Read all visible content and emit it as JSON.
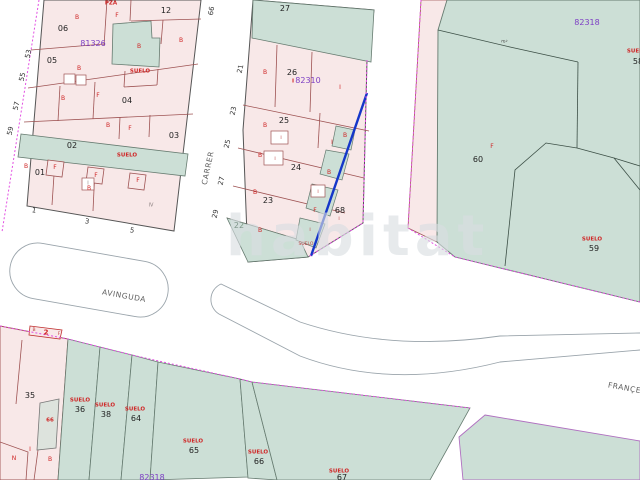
{
  "map": {
    "watermark": "habitat",
    "blocks": [
      {
        "id": "81326",
        "position": "top-left"
      },
      {
        "id": "82310",
        "position": "top-middle"
      },
      {
        "id": "82318",
        "position": "top-right"
      },
      {
        "id": "82318",
        "position": "bottom"
      }
    ],
    "streets": [
      {
        "name": "AVINGUDA"
      },
      {
        "name": "CARRER"
      },
      {
        "name": "FRANÇESC"
      }
    ],
    "selected_boundary_color": "#1536c9",
    "boundary_dash_color": "#e24fe2",
    "parcel_fill_pink": "#f8e8e8",
    "parcel_fill_green": "#ccdfd6",
    "block_label_color": "#7d3fc4",
    "status_label_color": "#cf2525",
    "labels": [
      {
        "t": "PZA",
        "c": "su",
        "x": 111,
        "y": 4
      },
      {
        "t": "06",
        "c": "pn",
        "x": 63,
        "y": 29
      },
      {
        "t": "12",
        "c": "pn",
        "x": 166,
        "y": 11
      },
      {
        "t": "81326",
        "c": "bk",
        "x": 93,
        "y": 44
      },
      {
        "t": "B",
        "c": "rl",
        "x": 77,
        "y": 18
      },
      {
        "t": "F",
        "c": "rl",
        "x": 117,
        "y": 16
      },
      {
        "t": "B",
        "c": "rl",
        "x": 181,
        "y": 41
      },
      {
        "t": "B",
        "c": "rl",
        "x": 139,
        "y": 47
      },
      {
        "t": "05",
        "c": "pn",
        "x": 52,
        "y": 61
      },
      {
        "t": "SUELO",
        "c": "su",
        "x": 140,
        "y": 72
      },
      {
        "t": "B",
        "c": "rl",
        "x": 79,
        "y": 69
      },
      {
        "t": "04",
        "c": "pn",
        "x": 127,
        "y": 101
      },
      {
        "t": "B",
        "c": "rl",
        "x": 63,
        "y": 99
      },
      {
        "t": "F",
        "c": "rl",
        "x": 98,
        "y": 96
      },
      {
        "t": "03",
        "c": "pn",
        "x": 174,
        "y": 136
      },
      {
        "t": "B",
        "c": "rl",
        "x": 108,
        "y": 126
      },
      {
        "t": "F",
        "c": "rl",
        "x": 130,
        "y": 129
      },
      {
        "t": "02",
        "c": "pn",
        "x": 72,
        "y": 146
      },
      {
        "t": "SUELO",
        "c": "su",
        "x": 127,
        "y": 156
      },
      {
        "t": "01",
        "c": "pn",
        "x": 40,
        "y": 173
      },
      {
        "t": "B",
        "c": "rl",
        "x": 26,
        "y": 167
      },
      {
        "t": "F",
        "c": "rl",
        "x": 55,
        "y": 168
      },
      {
        "t": "F",
        "c": "rl",
        "x": 96,
        "y": 176
      },
      {
        "t": "F",
        "c": "rl",
        "x": 138,
        "y": 181
      },
      {
        "t": "B",
        "c": "rl",
        "x": 89,
        "y": 189
      },
      {
        "t": "I",
        "c": "gy",
        "x": 88,
        "y": 184
      },
      {
        "t": "IV",
        "c": "gy",
        "x": 151,
        "y": 206
      },
      {
        "t": "53",
        "c": "st",
        "x": 29,
        "y": 54,
        "r": -78
      },
      {
        "t": "55",
        "c": "st",
        "x": 23,
        "y": 77,
        "r": -78
      },
      {
        "t": "57",
        "c": "st",
        "x": 17,
        "y": 106,
        "r": -78
      },
      {
        "t": "59",
        "c": "st",
        "x": 11,
        "y": 131,
        "r": -78
      },
      {
        "t": "1",
        "c": "st",
        "x": 34,
        "y": 211,
        "r": 10
      },
      {
        "t": "3",
        "c": "st",
        "x": 87,
        "y": 222,
        "r": 10
      },
      {
        "t": "5",
        "c": "st",
        "x": 132,
        "y": 231,
        "r": 10
      },
      {
        "t": "66",
        "c": "st",
        "x": 212,
        "y": 11,
        "r": -80
      },
      {
        "t": "21",
        "c": "st",
        "x": 241,
        "y": 69,
        "r": -78
      },
      {
        "t": "23",
        "c": "st",
        "x": 234,
        "y": 111,
        "r": -78
      },
      {
        "t": "25",
        "c": "st",
        "x": 228,
        "y": 144,
        "r": -78
      },
      {
        "t": "27",
        "c": "st",
        "x": 222,
        "y": 181,
        "r": -78
      },
      {
        "t": "29",
        "c": "st",
        "x": 216,
        "y": 214,
        "r": -78
      },
      {
        "t": "CARRER",
        "c": "sn",
        "x": 208,
        "y": 168,
        "r": -78
      },
      {
        "t": "27",
        "c": "pn",
        "x": 285,
        "y": 9
      },
      {
        "t": "26",
        "c": "pn",
        "x": 292,
        "y": 73
      },
      {
        "t": "82310",
        "c": "bk",
        "x": 308,
        "y": 81
      },
      {
        "t": "I",
        "c": "su",
        "x": 293,
        "y": 82
      },
      {
        "t": "B",
        "c": "rl",
        "x": 265,
        "y": 73
      },
      {
        "t": "I",
        "c": "rl",
        "x": 340,
        "y": 88
      },
      {
        "t": "25",
        "c": "pn",
        "x": 284,
        "y": 121
      },
      {
        "t": "B",
        "c": "rl",
        "x": 265,
        "y": 126
      },
      {
        "t": "I",
        "c": "tr",
        "x": 281,
        "y": 139
      },
      {
        "t": "I",
        "c": "rl",
        "x": 332,
        "y": 143
      },
      {
        "t": "24",
        "c": "pn",
        "x": 296,
        "y": 168
      },
      {
        "t": "B",
        "c": "rl",
        "x": 260,
        "y": 156
      },
      {
        "t": "I",
        "c": "tr",
        "x": 275,
        "y": 160
      },
      {
        "t": "23",
        "c": "pn",
        "x": 268,
        "y": 201
      },
      {
        "t": "B",
        "c": "rl",
        "x": 255,
        "y": 193
      },
      {
        "t": "22",
        "c": "pg",
        "x": 239,
        "y": 226
      },
      {
        "t": "B",
        "c": "rl",
        "x": 260,
        "y": 231
      },
      {
        "t": "68",
        "c": "pn",
        "x": 340,
        "y": 211
      },
      {
        "t": "I",
        "c": "tr",
        "x": 339,
        "y": 220
      },
      {
        "t": "B",
        "c": "rl",
        "x": 345,
        "y": 136
      },
      {
        "t": "B",
        "c": "rl",
        "x": 329,
        "y": 173
      },
      {
        "t": "I",
        "c": "tr",
        "x": 318,
        "y": 193
      },
      {
        "t": "F",
        "c": "rl",
        "x": 315,
        "y": 211
      },
      {
        "t": "I",
        "c": "tr",
        "x": 310,
        "y": 231
      },
      {
        "t": "SUELO",
        "c": "tr",
        "x": 306,
        "y": 245
      },
      {
        "t": "82318",
        "c": "bk",
        "x": 587,
        "y": 23
      },
      {
        "t": "m²",
        "c": "tn",
        "x": 504,
        "y": 43,
        "r": 10
      },
      {
        "t": "F",
        "c": "rl",
        "x": 492,
        "y": 147
      },
      {
        "t": "60",
        "c": "pn",
        "x": 478,
        "y": 160
      },
      {
        "t": "SUELO",
        "c": "su",
        "x": 592,
        "y": 240
      },
      {
        "t": "59",
        "c": "pn",
        "x": 594,
        "y": 249
      },
      {
        "t": "SUELO",
        "c": "su",
        "x": 637,
        "y": 52
      },
      {
        "t": "58",
        "c": "pn",
        "x": 638,
        "y": 62
      },
      {
        "t": "AVINGUDA",
        "c": "sn",
        "x": 124,
        "y": 296,
        "r": 10
      },
      {
        "t": "FRANÇESC",
        "c": "sn",
        "x": 630,
        "y": 389,
        "r": 10
      },
      {
        "t": "2",
        "c": "r2",
        "x": 46,
        "y": 333
      },
      {
        "t": "B",
        "c": "tr",
        "x": 34,
        "y": 331
      },
      {
        "t": "F",
        "c": "tr",
        "x": 59,
        "y": 335
      },
      {
        "t": "35",
        "c": "pn",
        "x": 30,
        "y": 396
      },
      {
        "t": "66",
        "c": "su",
        "x": 50,
        "y": 421
      },
      {
        "t": "I",
        "c": "rl",
        "x": 30,
        "y": 450
      },
      {
        "t": "N",
        "c": "rl",
        "x": 14,
        "y": 459
      },
      {
        "t": "B",
        "c": "rl",
        "x": 50,
        "y": 460
      },
      {
        "t": "SUELO",
        "c": "su",
        "x": 80,
        "y": 401
      },
      {
        "t": "36",
        "c": "pn",
        "x": 80,
        "y": 410
      },
      {
        "t": "SUELO",
        "c": "su",
        "x": 105,
        "y": 406
      },
      {
        "t": "38",
        "c": "pn",
        "x": 106,
        "y": 415
      },
      {
        "t": "SUELO",
        "c": "su",
        "x": 135,
        "y": 410
      },
      {
        "t": "64",
        "c": "pn",
        "x": 136,
        "y": 419
      },
      {
        "t": "SUELO",
        "c": "su",
        "x": 193,
        "y": 442
      },
      {
        "t": "65",
        "c": "pn",
        "x": 194,
        "y": 451
      },
      {
        "t": "SUELO",
        "c": "su",
        "x": 258,
        "y": 453
      },
      {
        "t": "66",
        "c": "pn",
        "x": 259,
        "y": 462
      },
      {
        "t": "SUELO",
        "c": "su",
        "x": 339,
        "y": 472
      },
      {
        "t": "67",
        "c": "pn",
        "x": 342,
        "y": 478
      },
      {
        "t": "82318",
        "c": "bk",
        "x": 152,
        "y": 478
      }
    ]
  }
}
